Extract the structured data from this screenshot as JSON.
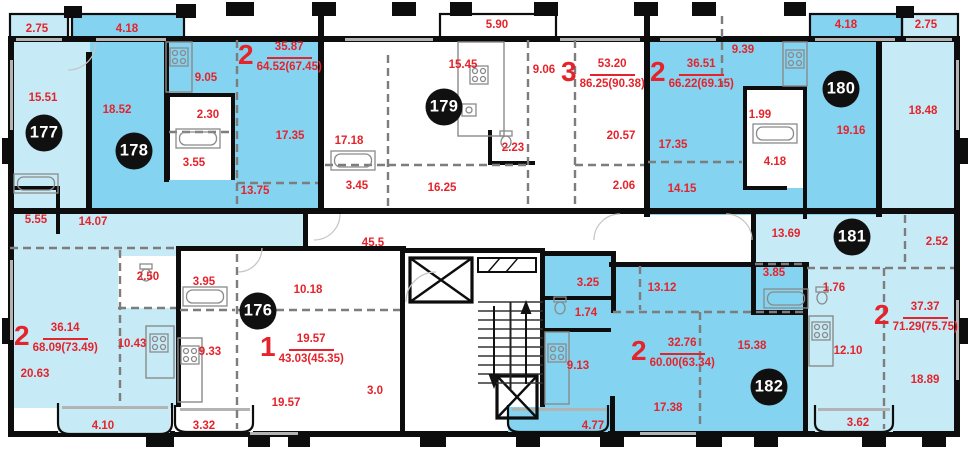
{
  "plan": {
    "type": "residential-floor-plan",
    "common_area_label": "45.5"
  },
  "colors": {
    "room_light": "#c6ebf7",
    "room_medium": "#84d3f0",
    "wall": "#0d0d0d",
    "dimension_text": "#e5232b",
    "badge_bg": "#101010",
    "badge_text": "#ffffff",
    "fixture_line": "#8a8a8a",
    "window_line": "#b3b3b3"
  },
  "apartments": [
    {
      "badge": "176",
      "type": "1",
      "living_area": "19.57",
      "total_area": "43.03(45.35)",
      "badge_x": 258,
      "badge_y": 311,
      "header_x": 260,
      "header_y": 332
    },
    {
      "badge": "177",
      "type": "2",
      "living_area": "36.14",
      "total_area": "68.09(73.49)",
      "badge_x": 44,
      "badge_y": 133,
      "header_x": 14,
      "header_y": 321
    },
    {
      "badge": "178",
      "type": "2",
      "living_area": "35.87",
      "total_area": "64.52(67.45)",
      "badge_x": 134,
      "badge_y": 151,
      "header_x": 238,
      "header_y": 40
    },
    {
      "badge": "179",
      "type": "3",
      "living_area": "53.20",
      "total_area": "86.25(90.38)",
      "badge_x": 444,
      "badge_y": 107,
      "header_x": 561,
      "header_y": 57
    },
    {
      "badge": "180",
      "type": "2",
      "living_area": "36.51",
      "total_area": "66.22(69.15)",
      "badge_x": 841,
      "badge_y": 89,
      "header_x": 650,
      "header_y": 57
    },
    {
      "badge": "181",
      "type": "2",
      "living_area": "37.37",
      "total_area": "71.29(75.75)",
      "badge_x": 852,
      "badge_y": 237,
      "header_x": 874,
      "header_y": 300
    },
    {
      "badge": "182",
      "type": "2",
      "living_area": "32.76",
      "total_area": "60.00(63.34)",
      "badge_x": 769,
      "badge_y": 387,
      "header_x": 631,
      "header_y": 336
    }
  ],
  "dimensions": [
    {
      "text": "2.75",
      "x": 37,
      "y": 29
    },
    {
      "text": "4.18",
      "x": 127,
      "y": 29
    },
    {
      "text": "5.90",
      "x": 497,
      "y": 25
    },
    {
      "text": "4.18",
      "x": 846,
      "y": 25
    },
    {
      "text": "2.75",
      "x": 926,
      "y": 25
    },
    {
      "text": "9.05",
      "x": 206,
      "y": 78
    },
    {
      "text": "15.45",
      "x": 463,
      "y": 65
    },
    {
      "text": "9.06",
      "x": 544,
      "y": 70
    },
    {
      "text": "9.39",
      "x": 743,
      "y": 50
    },
    {
      "text": "15.51",
      "x": 43,
      "y": 98
    },
    {
      "text": "18.52",
      "x": 117,
      "y": 110
    },
    {
      "text": "2.30",
      "x": 208,
      "y": 115
    },
    {
      "text": "1.99",
      "x": 760,
      "y": 115
    },
    {
      "text": "18.48",
      "x": 923,
      "y": 111
    },
    {
      "text": "17.35",
      "x": 290,
      "y": 136
    },
    {
      "text": "17.18",
      "x": 349,
      "y": 141
    },
    {
      "text": "20.57",
      "x": 621,
      "y": 136
    },
    {
      "text": "19.16",
      "x": 851,
      "y": 131
    },
    {
      "text": "2.23",
      "x": 513,
      "y": 148
    },
    {
      "text": "3.55",
      "x": 194,
      "y": 163
    },
    {
      "text": "4.18",
      "x": 775,
      "y": 162
    },
    {
      "text": "17.35",
      "x": 673,
      "y": 145
    },
    {
      "text": "3.45",
      "x": 357,
      "y": 186
    },
    {
      "text": "16.25",
      "x": 442,
      "y": 188
    },
    {
      "text": "13.75",
      "x": 255,
      "y": 191
    },
    {
      "text": "2.06",
      "x": 624,
      "y": 186
    },
    {
      "text": "14.15",
      "x": 682,
      "y": 189
    },
    {
      "text": "5.55",
      "x": 36,
      "y": 220
    },
    {
      "text": "14.07",
      "x": 93,
      "y": 222
    },
    {
      "text": "13.69",
      "x": 786,
      "y": 234
    },
    {
      "text": "2.52",
      "x": 937,
      "y": 242
    },
    {
      "text": "45.5",
      "x": 373,
      "y": 243
    },
    {
      "text": "2.50",
      "x": 148,
      "y": 277
    },
    {
      "text": "3.95",
      "x": 204,
      "y": 282
    },
    {
      "text": "3.85",
      "x": 774,
      "y": 273
    },
    {
      "text": "1.76",
      "x": 834,
      "y": 288
    },
    {
      "text": "10.18",
      "x": 308,
      "y": 290
    },
    {
      "text": "3.25",
      "x": 588,
      "y": 283
    },
    {
      "text": "13.12",
      "x": 662,
      "y": 288
    },
    {
      "text": "1.74",
      "x": 586,
      "y": 313
    },
    {
      "text": "10.43",
      "x": 132,
      "y": 344
    },
    {
      "text": "9.33",
      "x": 210,
      "y": 352
    },
    {
      "text": "9.13",
      "x": 578,
      "y": 366
    },
    {
      "text": "15.38",
      "x": 752,
      "y": 346
    },
    {
      "text": "12.10",
      "x": 848,
      "y": 351
    },
    {
      "text": "20.63",
      "x": 35,
      "y": 374
    },
    {
      "text": "3.0",
      "x": 375,
      "y": 391
    },
    {
      "text": "19.57",
      "x": 286,
      "y": 403
    },
    {
      "text": "17.38",
      "x": 668,
      "y": 408
    },
    {
      "text": "18.89",
      "x": 925,
      "y": 380
    },
    {
      "text": "4.10",
      "x": 103,
      "y": 426
    },
    {
      "text": "3.32",
      "x": 204,
      "y": 426
    },
    {
      "text": "4.77",
      "x": 593,
      "y": 426
    },
    {
      "text": "3.62",
      "x": 858,
      "y": 423
    }
  ]
}
